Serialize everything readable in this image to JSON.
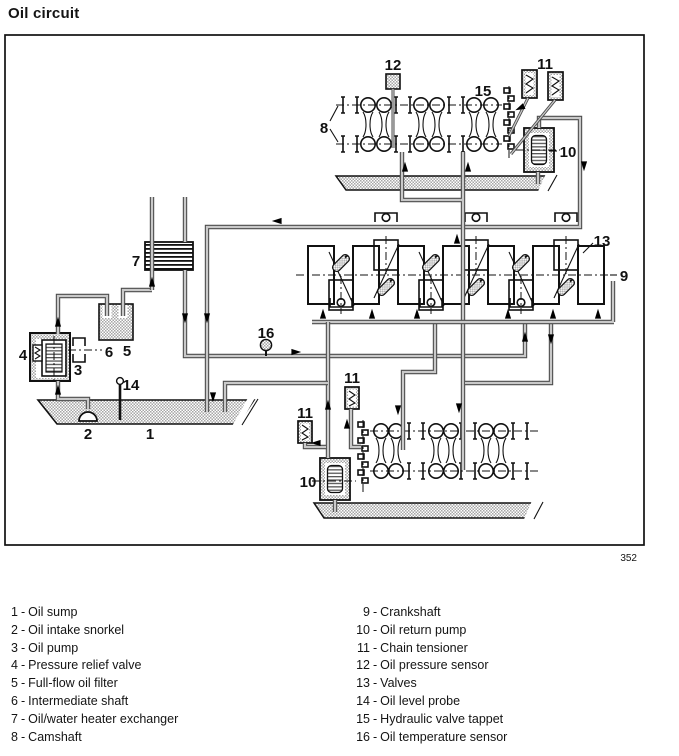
{
  "title": "Oil circuit",
  "figure_number": "352",
  "colors": {
    "ink": "#111111",
    "pipe_fill": "#c9c9c9",
    "pipe_edge": "#4d4d4d",
    "hatch_gray": "#a6a6a6"
  },
  "callouts": {
    "c1": "1",
    "c2": "2",
    "c3": "3",
    "c4": "4",
    "c5": "5",
    "c6": "6",
    "c7": "7",
    "c8": "8",
    "c9": "9",
    "c10": "10",
    "c11": "11",
    "c12": "12",
    "c13": "13",
    "c14": "14",
    "c15": "15",
    "c16": "16"
  },
  "legend": {
    "separator": "-",
    "left": [
      {
        "num": "1",
        "label": "Oil sump"
      },
      {
        "num": "2",
        "label": "Oil intake snorkel"
      },
      {
        "num": "3",
        "label": "Oil pump"
      },
      {
        "num": "4",
        "label": "Pressure relief valve"
      },
      {
        "num": "5",
        "label": "Full-flow oil filter"
      },
      {
        "num": "6",
        "label": "Intermediate shaft"
      },
      {
        "num": "7",
        "label": "Oil/water heater exchanger"
      },
      {
        "num": "8",
        "label": "Camshaft"
      }
    ],
    "right": [
      {
        "num": "9",
        "label": "Crankshaft"
      },
      {
        "num": "10",
        "label": "Oil return pump"
      },
      {
        "num": "11",
        "label": "Chain tensioner"
      },
      {
        "num": "12",
        "label": "Oil pressure sensor"
      },
      {
        "num": "13",
        "label": "Valves"
      },
      {
        "num": "14",
        "label": "Oil level probe"
      },
      {
        "num": "15",
        "label": "Hydraulic valve tappet"
      },
      {
        "num": "16",
        "label": "Oil temperature sensor"
      }
    ]
  }
}
